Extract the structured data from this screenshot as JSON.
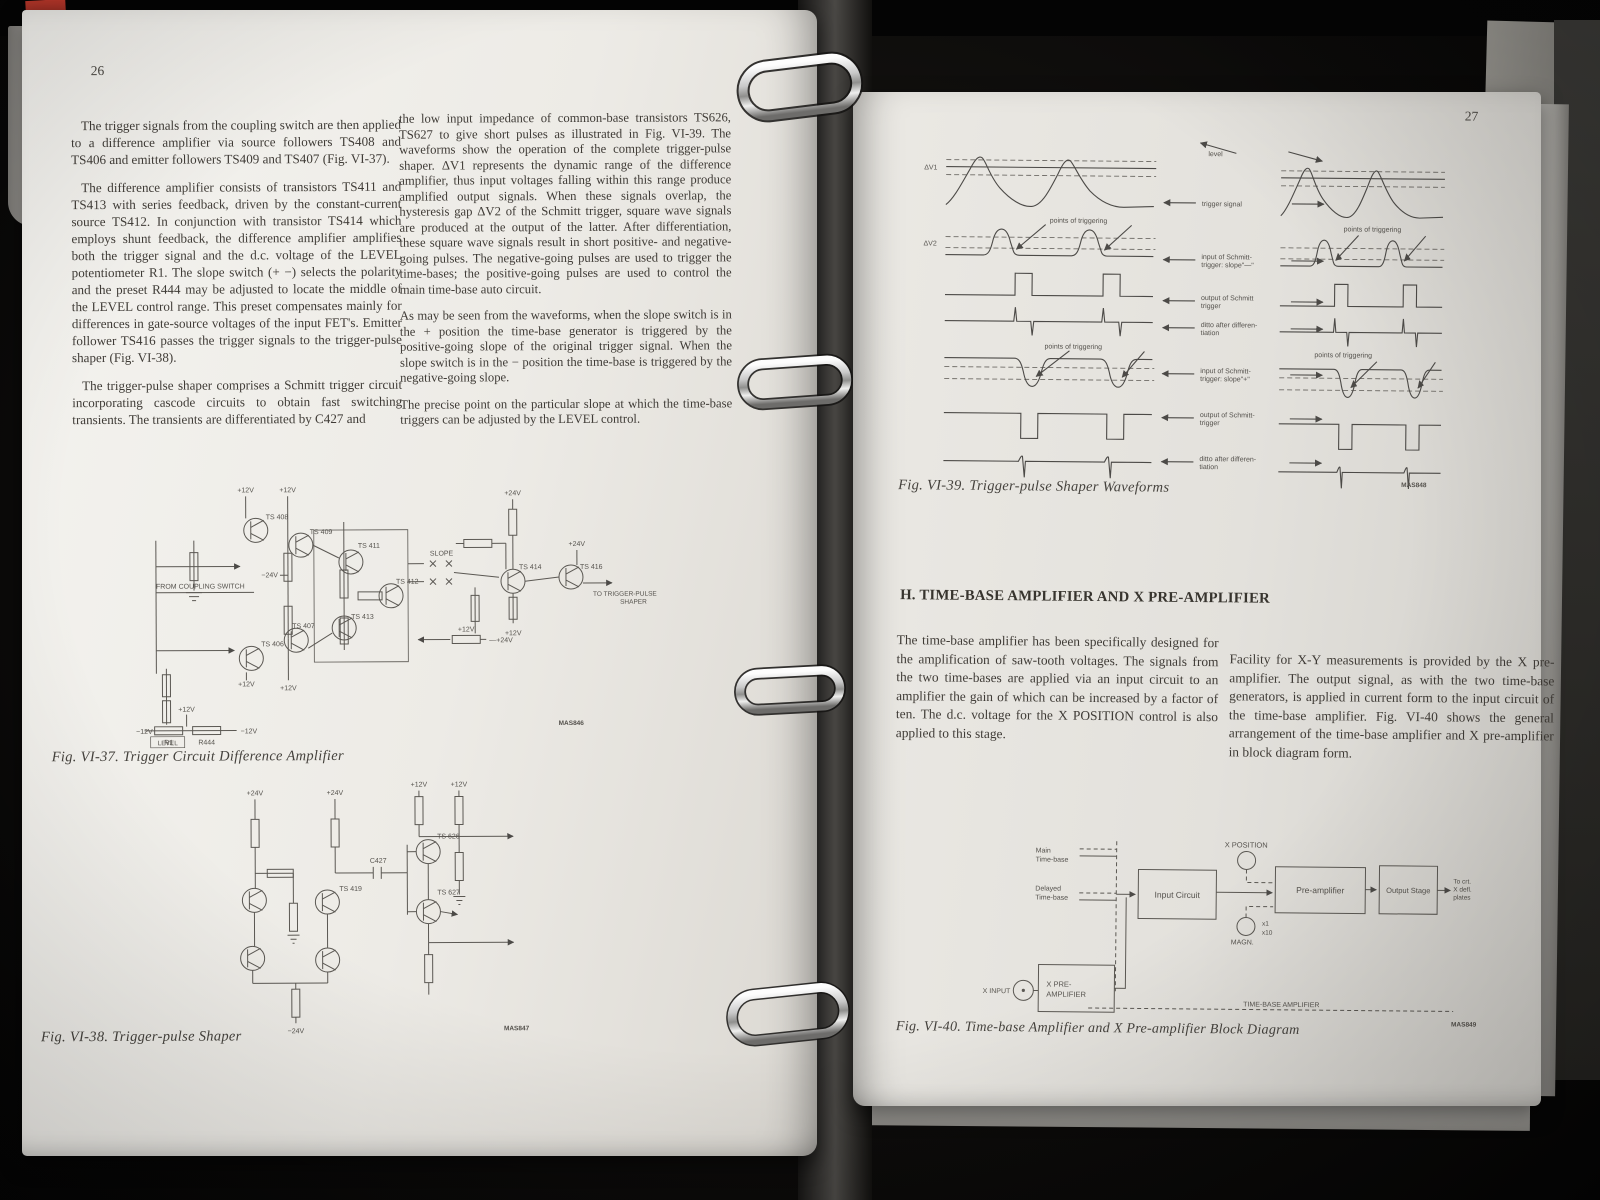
{
  "left": {
    "num": "26",
    "col1": [
      "The trigger signals from the coupling switch are then applied to a difference amplifier via source followers TS408 and TS406 and emitter followers TS409 and TS407 (Fig. VI-37).",
      "The difference amplifier consists of transistors TS411 and TS413 with series feedback, driven by the constant-current source TS412. In conjunction with transistor TS414 which employs shunt feedback, the difference amplifier amplifies both the trigger signal and the d.c. voltage of the LEVEL potentiometer R1. The slope switch (+ −) selects the polarity and the preset R444 may be adjusted to locate the middle of the LEVEL control range. This preset compensates mainly for differences in gate-source voltages of the input FET's. Emitter follower TS416 passes the trigger signals to the trigger-pulse shaper (Fig. VI-38).",
      "The trigger-pulse shaper comprises a Schmitt trigger circuit incorporating cascode circuits to obtain fast switching transients. The transients are differentiated by C427 and"
    ],
    "col2": [
      "the low input impedance of common-base transistors TS626, TS627 to give short pulses as illustrated in Fig. VI-39. The waveforms show the operation of the complete trigger-pulse shaper. ΔV1 represents the dynamic range of the difference amplifier, thus input voltages falling within this range produce amplified output signals. When these signals overlap, the hysteresis gap ΔV2 of the Schmitt trigger, square wave signals are produced at the output of the latter. After differentiation, these square wave signals result in short positive- and negative-going pulses. The negative-going pulses are used to trigger the time-bases; the positive-going pulses are used to control the main time-base auto circuit.",
      "As may be seen from the waveforms, when the slope switch is in the + position the time-base generator is triggered by the positive-going slope of the original trigger signal. When the slope switch is in the − position the time-base is triggered by the negative-going slope.",
      "The precise point on the particular slope at which the time-base triggers can be adjusted by the LEVEL control."
    ],
    "fig37": {
      "caption": "Fig. VI-37. Trigger Circuit Difference Amplifier",
      "t": [
        "+12V",
        "+12V",
        "TS 408",
        "TS 409",
        "TS 411",
        "TS 412",
        "TS 413",
        "TS 406",
        "TS 407",
        "FROM COUPLING SWITCH",
        "−24V",
        "SLOPE",
        "+24V",
        "TS 414",
        "+24V",
        "TS 416",
        "TO TRIGGER-PULSE",
        "SHAPER",
        "+12V",
        "+12V",
        "+12V",
        "+12V",
        "—+24V",
        "−12V",
        "+12V",
        "−12V",
        "R1",
        "R444",
        "LEVEL",
        "MAS846"
      ]
    },
    "fig38": {
      "caption": "Fig. VI-38. Trigger-pulse Shaper",
      "t": [
        "+24V",
        "+24V",
        "+12V",
        "+12V",
        "C427",
        "TS 626",
        "TS 419",
        "TS 627",
        "−24V",
        "MAS847"
      ]
    }
  },
  "right": {
    "num": "27",
    "heading": "H. TIME-BASE AMPLIFIER AND X PRE-AMPLIFIER",
    "col1": "The time-base amplifier has been specifically designed for the amplification of saw-tooth voltages. The signals from the two time-bases are applied via an input circuit to an amplifier the gain of which can be increased by a factor of ten. The d.c. voltage for the X POSITION control is also applied to this stage.",
    "col2": "Facility for X-Y measurements is provided by the X pre-amplifier. The output signal, as with the two time-base generators, is applied in current form to the input circuit of the time-base amplifier. Fig. VI-40 shows the general arrangement of the time-base amplifier and X pre-amplifier in block diagram form.",
    "fig39": {
      "caption": "Fig. VI-39. Trigger-pulse Shaper Waveforms",
      "t": [
        "level",
        "trigger signal",
        "points of triggering",
        "points of triggering",
        "points of triggering",
        "points of triggering",
        "input of Schmitt-",
        "trigger: slope\"—\"",
        "output of Schmitt",
        "trigger",
        "ditto after differen-",
        "tiation",
        "input of Schmitt-",
        "trigger: slope\"+\"",
        "output of Schmitt-",
        "trigger",
        "ditto after differen-",
        "tiation",
        "ΔV1",
        "ΔV2",
        "MAS848"
      ]
    },
    "fig40": {
      "caption": "Fig. VI-40. Time-base Amplifier and X Pre-amplifier  Block Diagram",
      "t": [
        "Main",
        "Time-base",
        "Delayed",
        "Time-base",
        "Input Circuit",
        "X POSITION",
        "Pre-amplifier",
        "MAGN.",
        "x1",
        "x10",
        "Output Stage",
        "To crt.",
        "X defl.",
        "plates",
        "X INPUT",
        "X PRE-",
        "AMPLIFIER",
        "TIME-BASE  AMPLIFIER",
        "MAS849"
      ]
    }
  }
}
